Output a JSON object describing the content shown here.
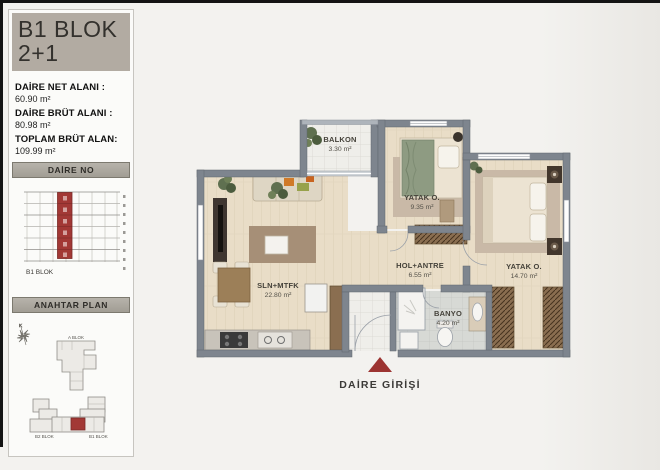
{
  "header": {
    "block_title": "B1 BLOK",
    "unit_type": "2+1"
  },
  "areas": {
    "net_label": "DAİRE NET ALANI :",
    "net_value": "60.90 m²",
    "brut_label": "DAİRE BRÜT ALANI :",
    "brut_value": "80.98 m²",
    "toplam_label": "TOPLAM BRÜT ALAN:",
    "toplam_value": "109.99 m²"
  },
  "daire_no": {
    "title": "DAİRE NO",
    "block_label": "B1 BLOK"
  },
  "anahtar_plan": {
    "title": "ANAHTAR PLAN",
    "north_label": "K",
    "block_a": "A BLOK",
    "block_b2": "B2 BLOK",
    "block_b1": "B1 BLOK"
  },
  "plan": {
    "rooms": [
      {
        "name": "BALKON",
        "area": "3.30 m²"
      },
      {
        "name": "YATAK O.",
        "area": "9.35 m²"
      },
      {
        "name": "YATAK O.",
        "area": "14.70 m²"
      },
      {
        "name": "HOL+ANTRE",
        "area": "6.55 m²"
      },
      {
        "name": "SLN+MTFK",
        "area": "22.80 m²"
      },
      {
        "name": "BANYO",
        "area": "4.20 m²"
      }
    ],
    "entrance_label": "DAİRE GİRİŞİ"
  },
  "colors": {
    "accent_red": "#9c3431",
    "wall_gray": "#7e858e",
    "title_bg": "#b2aba2"
  }
}
